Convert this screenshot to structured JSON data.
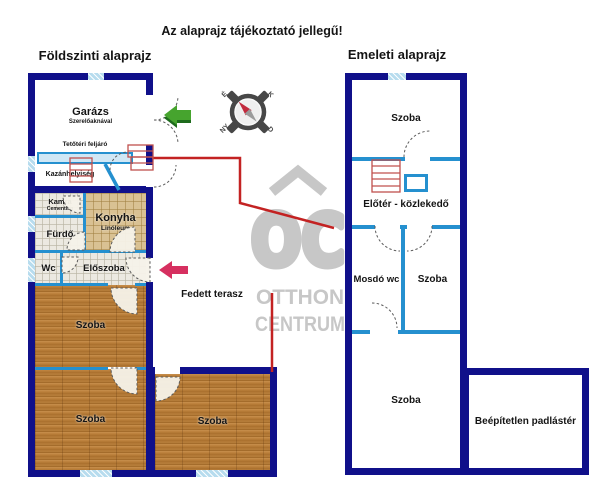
{
  "page": {
    "disclaimer": "Az alaprajz tájékoztató jellegű!"
  },
  "ground_floor": {
    "title": "Földszinti alaprajz",
    "rooms": {
      "garage": {
        "name": "Garázs",
        "sub": "Szerelőaknával"
      },
      "attic_stairs": {
        "name": "Tetőtéri feljáró"
      },
      "boiler": {
        "name": "Kazánhelyiség"
      },
      "pantry": {
        "name": "Kamra",
        "sub": "Cementlap"
      },
      "kitchen": {
        "name": "Konyha",
        "sub": "Linóleum"
      },
      "bathroom": {
        "name": "Fürdő"
      },
      "wc": {
        "name": "Wc"
      },
      "hall": {
        "name": "Előszoba"
      },
      "terrace": {
        "name": "Fedett terasz"
      },
      "room1": {
        "name": "Szoba"
      },
      "room2": {
        "name": "Szoba"
      },
      "room3": {
        "name": "Szoba"
      }
    }
  },
  "upper_floor": {
    "title": "Emeleti alaprajz",
    "rooms": {
      "room_top": {
        "name": "Szoba"
      },
      "hallway": {
        "name": "Előtér - közlekedő"
      },
      "washroom": {
        "name": "Mosdó wc"
      },
      "room_small": {
        "name": "Szoba"
      },
      "room_large": {
        "name": "Szoba"
      },
      "attic": {
        "name": "Beépítetlen padlástér"
      }
    }
  },
  "compass": {
    "north": "É",
    "east": "K",
    "south": "D",
    "west": "NY"
  },
  "watermark": {
    "logo": "OC",
    "line1": "OTTHON",
    "line2": "CENTRUM"
  },
  "colors": {
    "outer_wall": "#10108a",
    "partition": "#2590cf",
    "window": "#b7dcee",
    "stairs": "#c0504d",
    "marker_line": "#c32222",
    "arrow_green": "#46a42e",
    "arrow_pink": "#d63060"
  }
}
